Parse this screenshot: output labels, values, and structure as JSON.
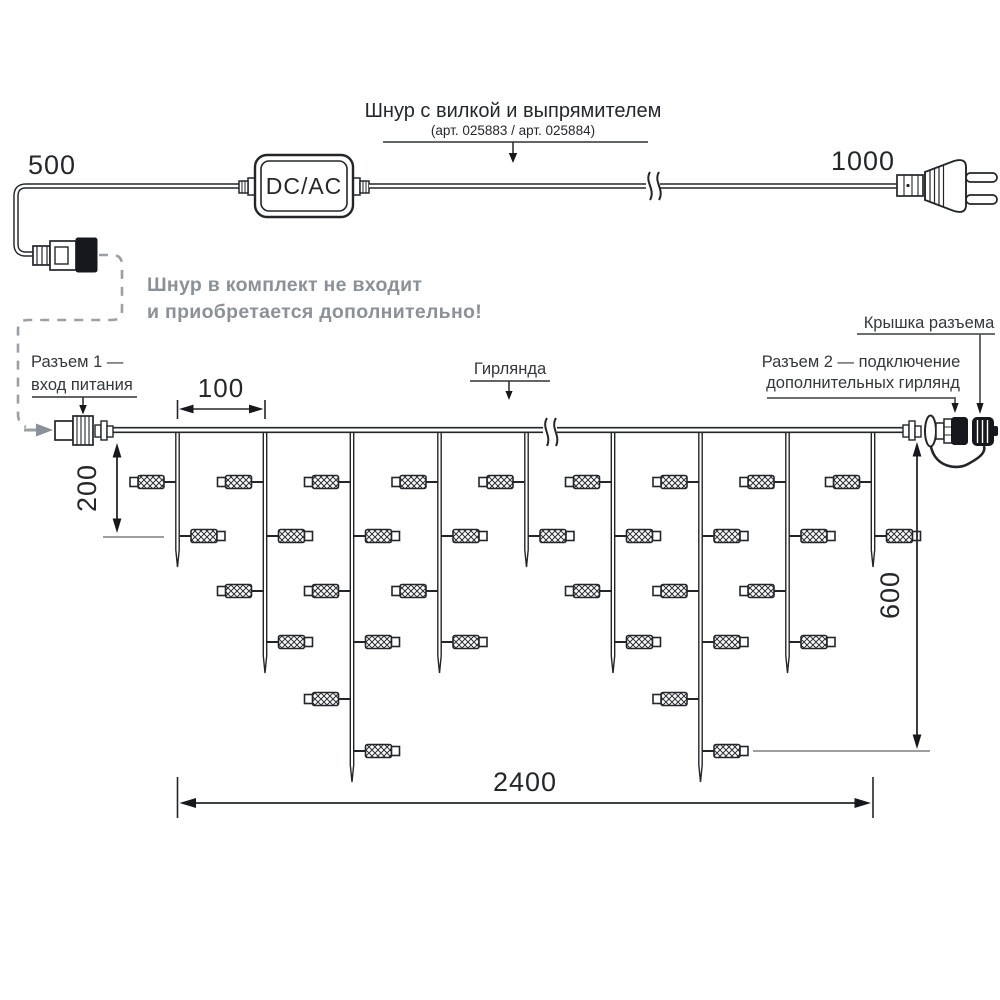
{
  "cord": {
    "title": "Шнур с вилкой и выпрямителем",
    "subtitle": "(арт. 025883 / арт. 025884)",
    "converter_label": "DC/AC",
    "len_left": "500",
    "len_right": "1000"
  },
  "note": {
    "line1": "Шнур в комплект не входит",
    "line2": "и приобретается дополнительно!"
  },
  "labels": {
    "connector1_line1": "Разъем 1 —",
    "connector1_line2": "вход питания",
    "garland": "Гирлянда",
    "connector2_line1": "Разъем 2 — подключение",
    "connector2_line2": "дополнительных гирлянд",
    "cap": "Крышка разъема"
  },
  "dimensions": {
    "spacing": "100",
    "drop_min": "200",
    "drop_max": "600",
    "length": "2400"
  },
  "garland": {
    "wire_y": 430,
    "lamp_rows_y": [
      482,
      536,
      591,
      642,
      699,
      751
    ],
    "strands": [
      {
        "x": 177.5,
        "lamps": 2
      },
      {
        "x": 265,
        "lamps": 4
      },
      {
        "x": 352,
        "lamps": 6
      },
      {
        "x": 439.5,
        "lamps": 4
      },
      {
        "x": 526.5,
        "lamps": 2
      },
      {
        "x": 613,
        "lamps": 4
      },
      {
        "x": 700.5,
        "lamps": 6
      },
      {
        "x": 787.5,
        "lamps": 4
      },
      {
        "x": 873,
        "lamps": 2
      }
    ]
  },
  "colors": {
    "line": "#22262b",
    "gray_text": "#8b9199",
    "leader": "#54595e",
    "dashed": "#9aa0a6"
  }
}
